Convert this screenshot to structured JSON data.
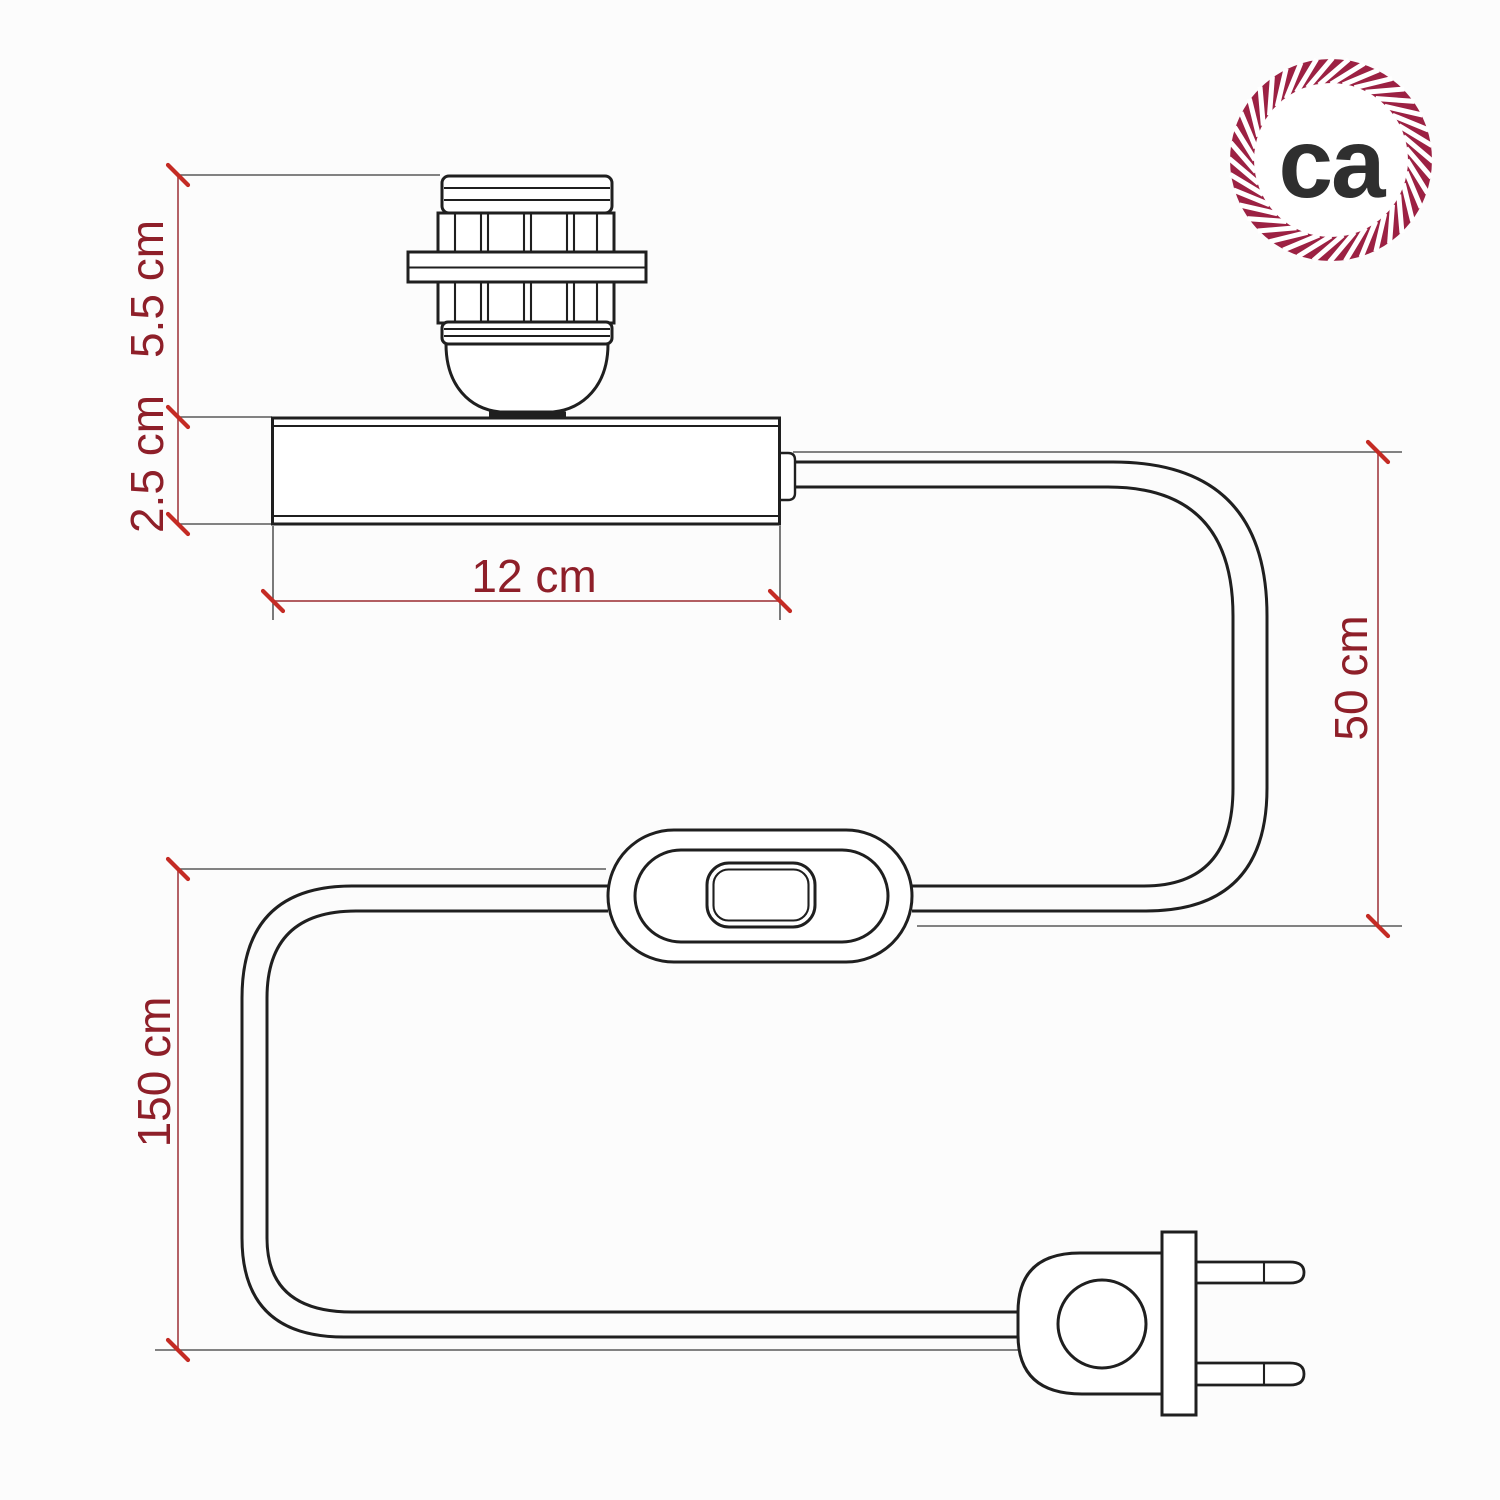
{
  "background_color": "#fcfcfc",
  "logo": {
    "text": "ca",
    "rope_color": "#9c2143",
    "text_color": "#2f2f2f"
  },
  "dimension_labels": {
    "socket_height": "5.5 cm",
    "base_height": "2.5 cm",
    "base_width": "12 cm",
    "cable_drop": "50 cm",
    "cable_length": "150 cm"
  },
  "annotation_colors": {
    "label_text": "#8e1f29",
    "dimension_line": "#a8474d",
    "tick": "#c42b24",
    "extension_line": "#595959",
    "drawing_line": "#1f1f1f"
  }
}
